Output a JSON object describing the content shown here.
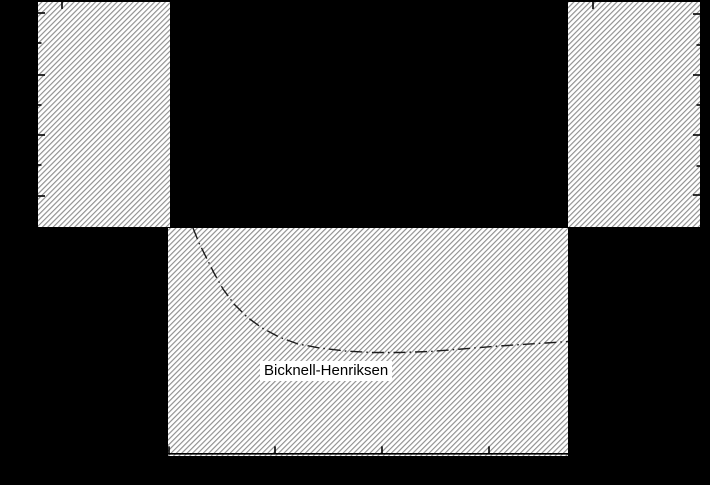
{
  "figure": {
    "width": 710,
    "height": 485,
    "background": "#000000",
    "hatch": {
      "fill": "#ffffff",
      "line_color": "#8f8f8f",
      "period": 3.8,
      "line_width": 1.15,
      "direction": "forward-slash"
    },
    "regions": [
      {
        "name": "upper-left-hatched-region",
        "x": 38,
        "y": 2,
        "w": 132,
        "h": 225
      },
      {
        "name": "upper-right-hatched-region",
        "x": 568,
        "y": 2,
        "w": 132,
        "h": 225
      },
      {
        "name": "lower-center-hatched-region",
        "x": 168,
        "y": 228,
        "w": 400,
        "h": 228
      }
    ],
    "axes": {
      "color": "#000000",
      "tick_width": 1.6,
      "bottom_spine": {
        "x1": 168,
        "x2": 568,
        "y": 453.8,
        "stroke_width": 1.6
      },
      "tick_sets": [
        {
          "name": "left-major-ticks",
          "edge": "left",
          "x": 38,
          "ys": [
            13,
            75,
            135,
            196
          ],
          "len": 7
        },
        {
          "name": "left-minor-ticks",
          "edge": "left",
          "x": 38,
          "ys": [
            43,
            105,
            165
          ],
          "len": 3.5
        },
        {
          "name": "right-major-ticks",
          "edge": "right",
          "x": 700,
          "ys": [
            14,
            75,
            135,
            195
          ],
          "len": 7
        },
        {
          "name": "right-minor-ticks",
          "edge": "right",
          "x": 700,
          "ys": [
            45,
            105,
            166
          ],
          "len": 3.5
        },
        {
          "name": "top-ticks",
          "edge": "top",
          "y": 2,
          "xs": [
            62,
            593
          ],
          "len": 7
        },
        {
          "name": "bottom-ticks",
          "edge": "bottom",
          "y": 453.8,
          "xs": [
            169,
            275,
            382,
            489
          ],
          "len": 7.5
        }
      ]
    },
    "curve": {
      "color": "#1c1c1c",
      "stroke_width": 1.4,
      "dash": "12 4 1.6 4",
      "points": [
        [
          193,
          228
        ],
        [
          199,
          243
        ],
        [
          206,
          257
        ],
        [
          214,
          273
        ],
        [
          223,
          289
        ],
        [
          234,
          304
        ],
        [
          247,
          317
        ],
        [
          262,
          328
        ],
        [
          279,
          337
        ],
        [
          298,
          344
        ],
        [
          320,
          348
        ],
        [
          345,
          351
        ],
        [
          372,
          352.5
        ],
        [
          400,
          352.5
        ],
        [
          430,
          351.5
        ],
        [
          462,
          349
        ],
        [
          492,
          346.5
        ],
        [
          522,
          344.5
        ],
        [
          546,
          343
        ],
        [
          568,
          341.5
        ]
      ]
    },
    "curve_label": {
      "text": "Bicknell-Henriksen",
      "x": 260,
      "y": 361,
      "font_size": 15,
      "bg": "#ffffff",
      "color": "#000000"
    }
  },
  "chart_data": {
    "type": "line",
    "title": "",
    "xlabel": "",
    "ylabel": "",
    "axis_labels_visible": false,
    "notes": "Figure rendered on a black page background; axis numbers and axis titles are black-on-black and not visible. Visible content: three diagonally hatched (forbidden) regions forming a valley shape, inward axis tick marks, and one dash-dot model curve.",
    "annotations": [
      "Bicknell-Henriksen"
    ],
    "legend": [],
    "grid": false,
    "series": [
      {
        "name": "Bicknell-Henriksen",
        "style": "dash-dot",
        "points_px": [
          [
            193,
            228
          ],
          [
            199,
            243
          ],
          [
            206,
            257
          ],
          [
            214,
            273
          ],
          [
            223,
            289
          ],
          [
            234,
            304
          ],
          [
            247,
            317
          ],
          [
            262,
            328
          ],
          [
            279,
            337
          ],
          [
            298,
            344
          ],
          [
            320,
            348
          ],
          [
            345,
            351
          ],
          [
            372,
            352.5
          ],
          [
            400,
            352.5
          ],
          [
            430,
            351.5
          ],
          [
            462,
            349
          ],
          [
            492,
            346.5
          ],
          [
            522,
            344.5
          ],
          [
            546,
            343
          ],
          [
            568,
            341.5
          ]
        ]
      }
    ],
    "regions_px": [
      {
        "name": "upper-left-hatched-region",
        "x": 38,
        "y": 2,
        "w": 132,
        "h": 225
      },
      {
        "name": "upper-right-hatched-region",
        "x": 568,
        "y": 2,
        "w": 132,
        "h": 225
      },
      {
        "name": "lower-center-hatched-region",
        "x": 168,
        "y": 228,
        "w": 400,
        "h": 228
      }
    ]
  }
}
